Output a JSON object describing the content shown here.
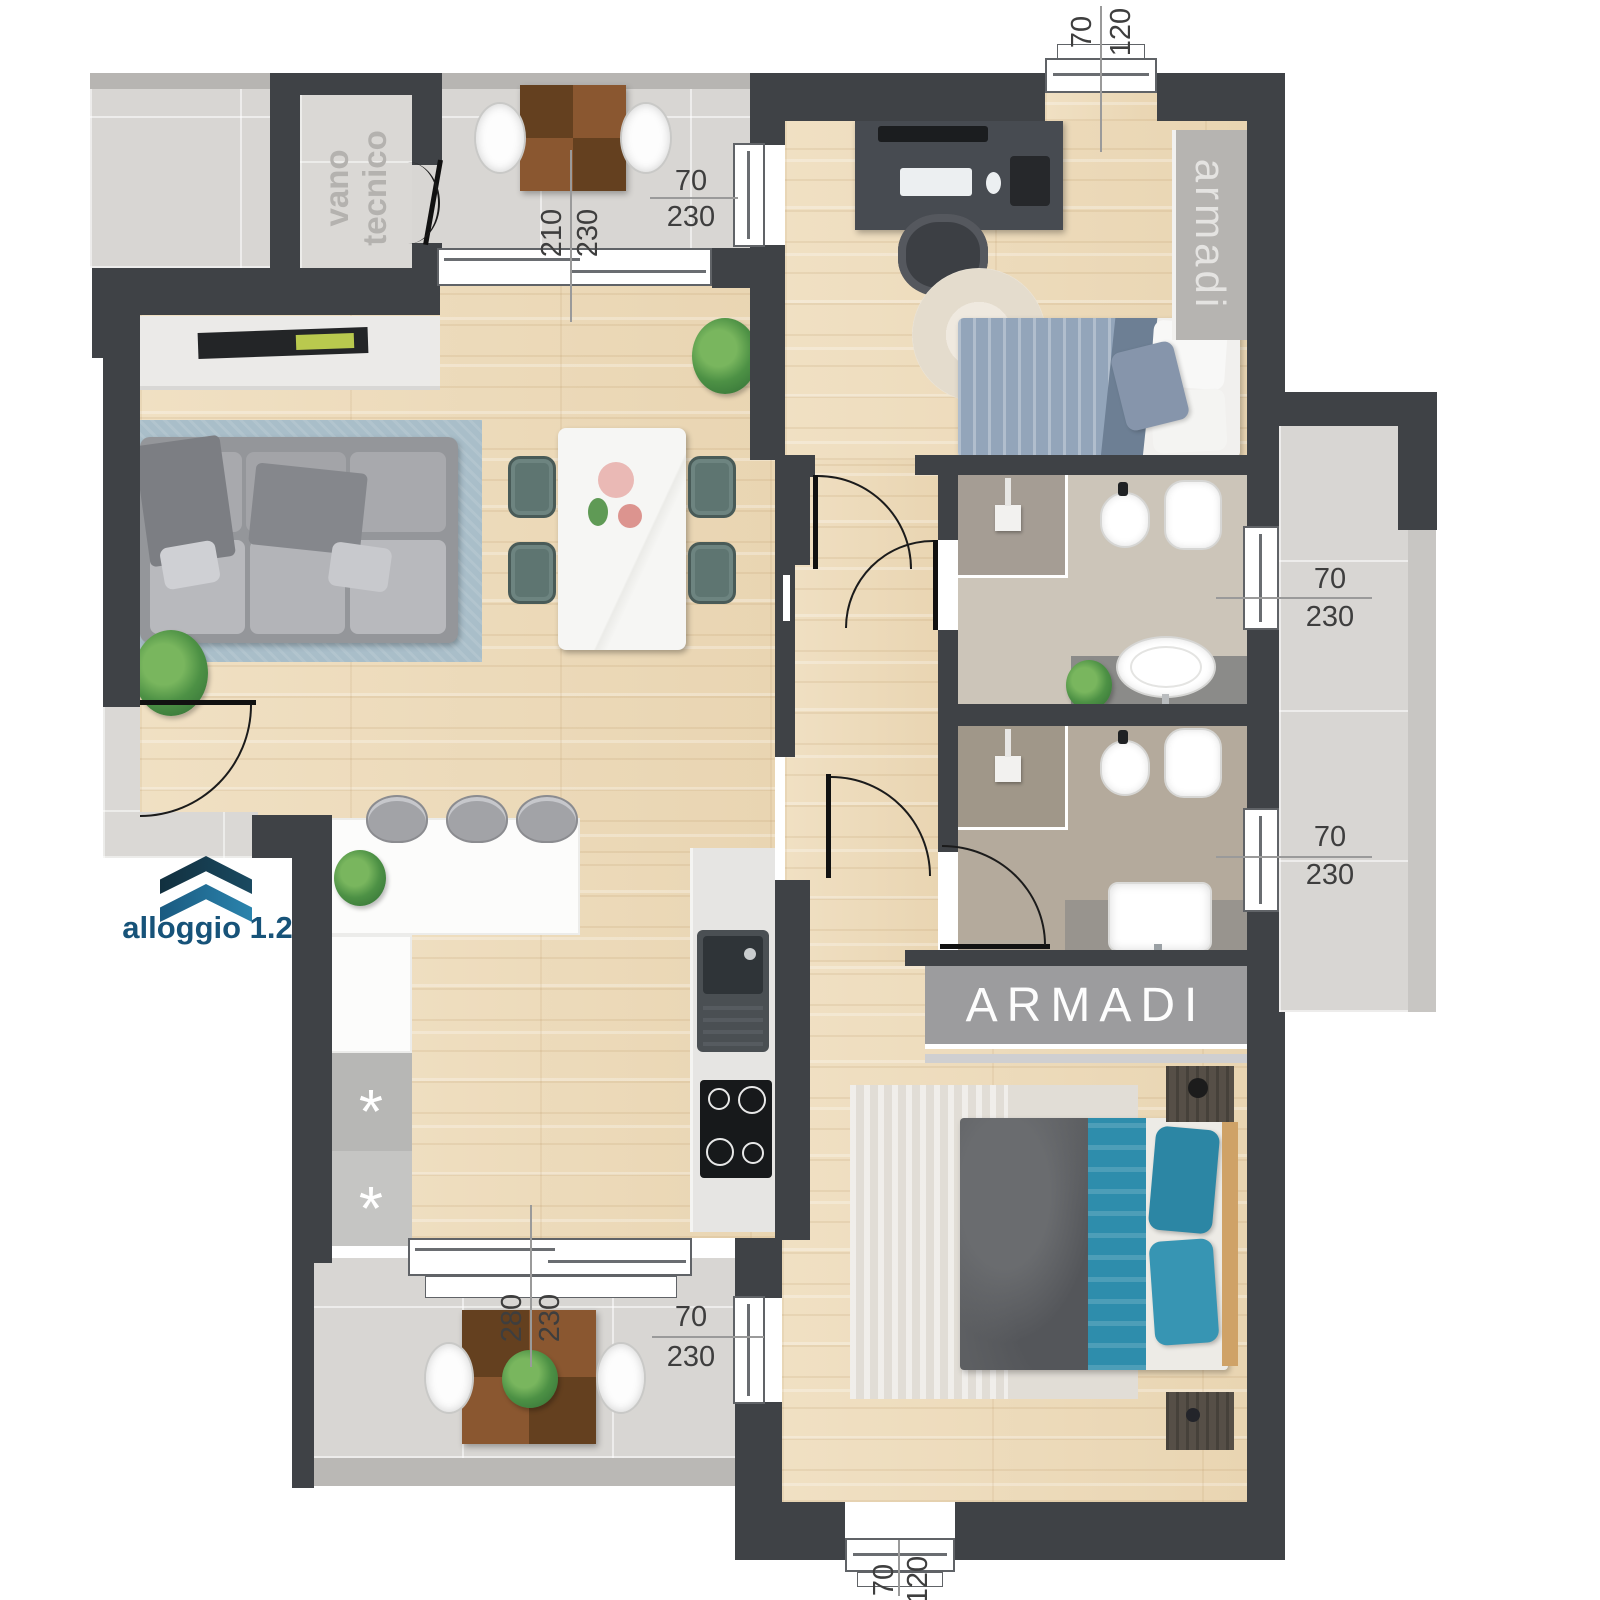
{
  "title": "alloggio 1.2 floor plan",
  "unit": {
    "label": "alloggio 1.2"
  },
  "rooms": {
    "vano_tecnico": "vano tecnico",
    "wardrobe_vertical": "armadi",
    "wardrobe_horizontal": "ARMADI"
  },
  "kitchen": {
    "appliance_marker_1": "*",
    "appliance_marker_2": "*"
  },
  "dimensions": {
    "window_top": {
      "w": "70",
      "h": "120"
    },
    "sliding_door_living": {
      "w": "210",
      "h": "230"
    },
    "window_bedroom1_side": {
      "w": "70",
      "h": "230"
    },
    "window_bath1": {
      "w": "70",
      "h": "230"
    },
    "window_bath2": {
      "w": "70",
      "h": "230"
    },
    "sliding_door_kitchen": {
      "w": "280",
      "h": "230"
    },
    "window_bedroom2_side": {
      "w": "70",
      "h": "230"
    },
    "window_bottom": {
      "w": "70",
      "h": "120"
    }
  },
  "colors": {
    "wall": "#3f4246",
    "wood": "#ecd9bb",
    "tile": "#d8d6d3",
    "accent_blue": "#175379",
    "teal_bed": "#2e8cab",
    "rug_blue": "#a9bec9"
  }
}
